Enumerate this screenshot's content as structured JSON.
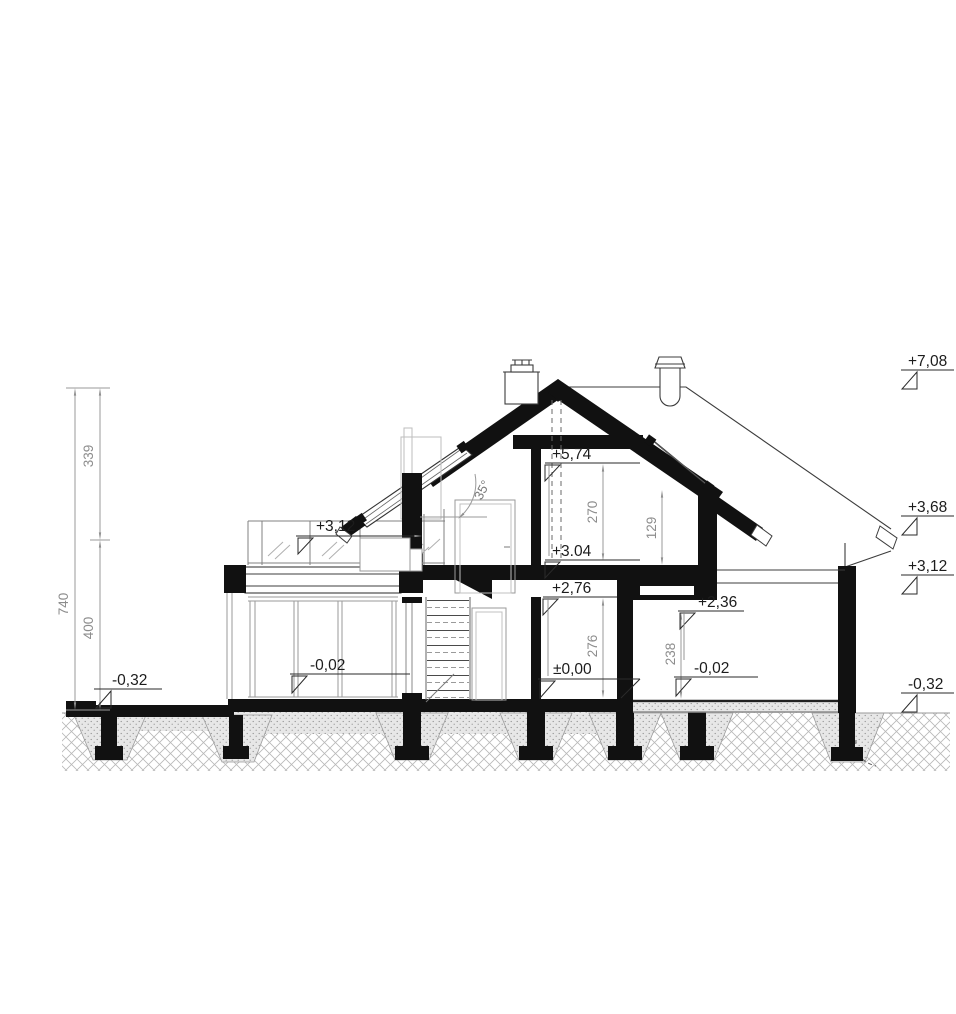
{
  "drawing": {
    "type": "house-cross-section",
    "pitch": "35°",
    "levels_right": {
      "ridge": "+7,08",
      "eaves": "+3,68",
      "porch_roof": "+3,12",
      "ground": "-0,32"
    },
    "levels_interior": {
      "attic_ceiling": "+5,74",
      "attic_floor": "+3.04",
      "gf_ceiling": "+2,76",
      "gf_floor": "±0,00",
      "porch_ceiling": "+2,36",
      "porch_floor": "-0,02",
      "terrace_threshold": "-0,02",
      "terrace_ground": "-0,32",
      "balcony": "+3,12"
    },
    "dims": {
      "total": "740",
      "roof_zone": "339",
      "wall_zone": "400",
      "attic_room": "270",
      "knee": "129",
      "gf_room": "276",
      "porch_room": "238"
    },
    "colors": {
      "ink": "#111111",
      "dim_gray": "#8d8d8d",
      "hatch_gray": "#b8b8b8"
    }
  }
}
